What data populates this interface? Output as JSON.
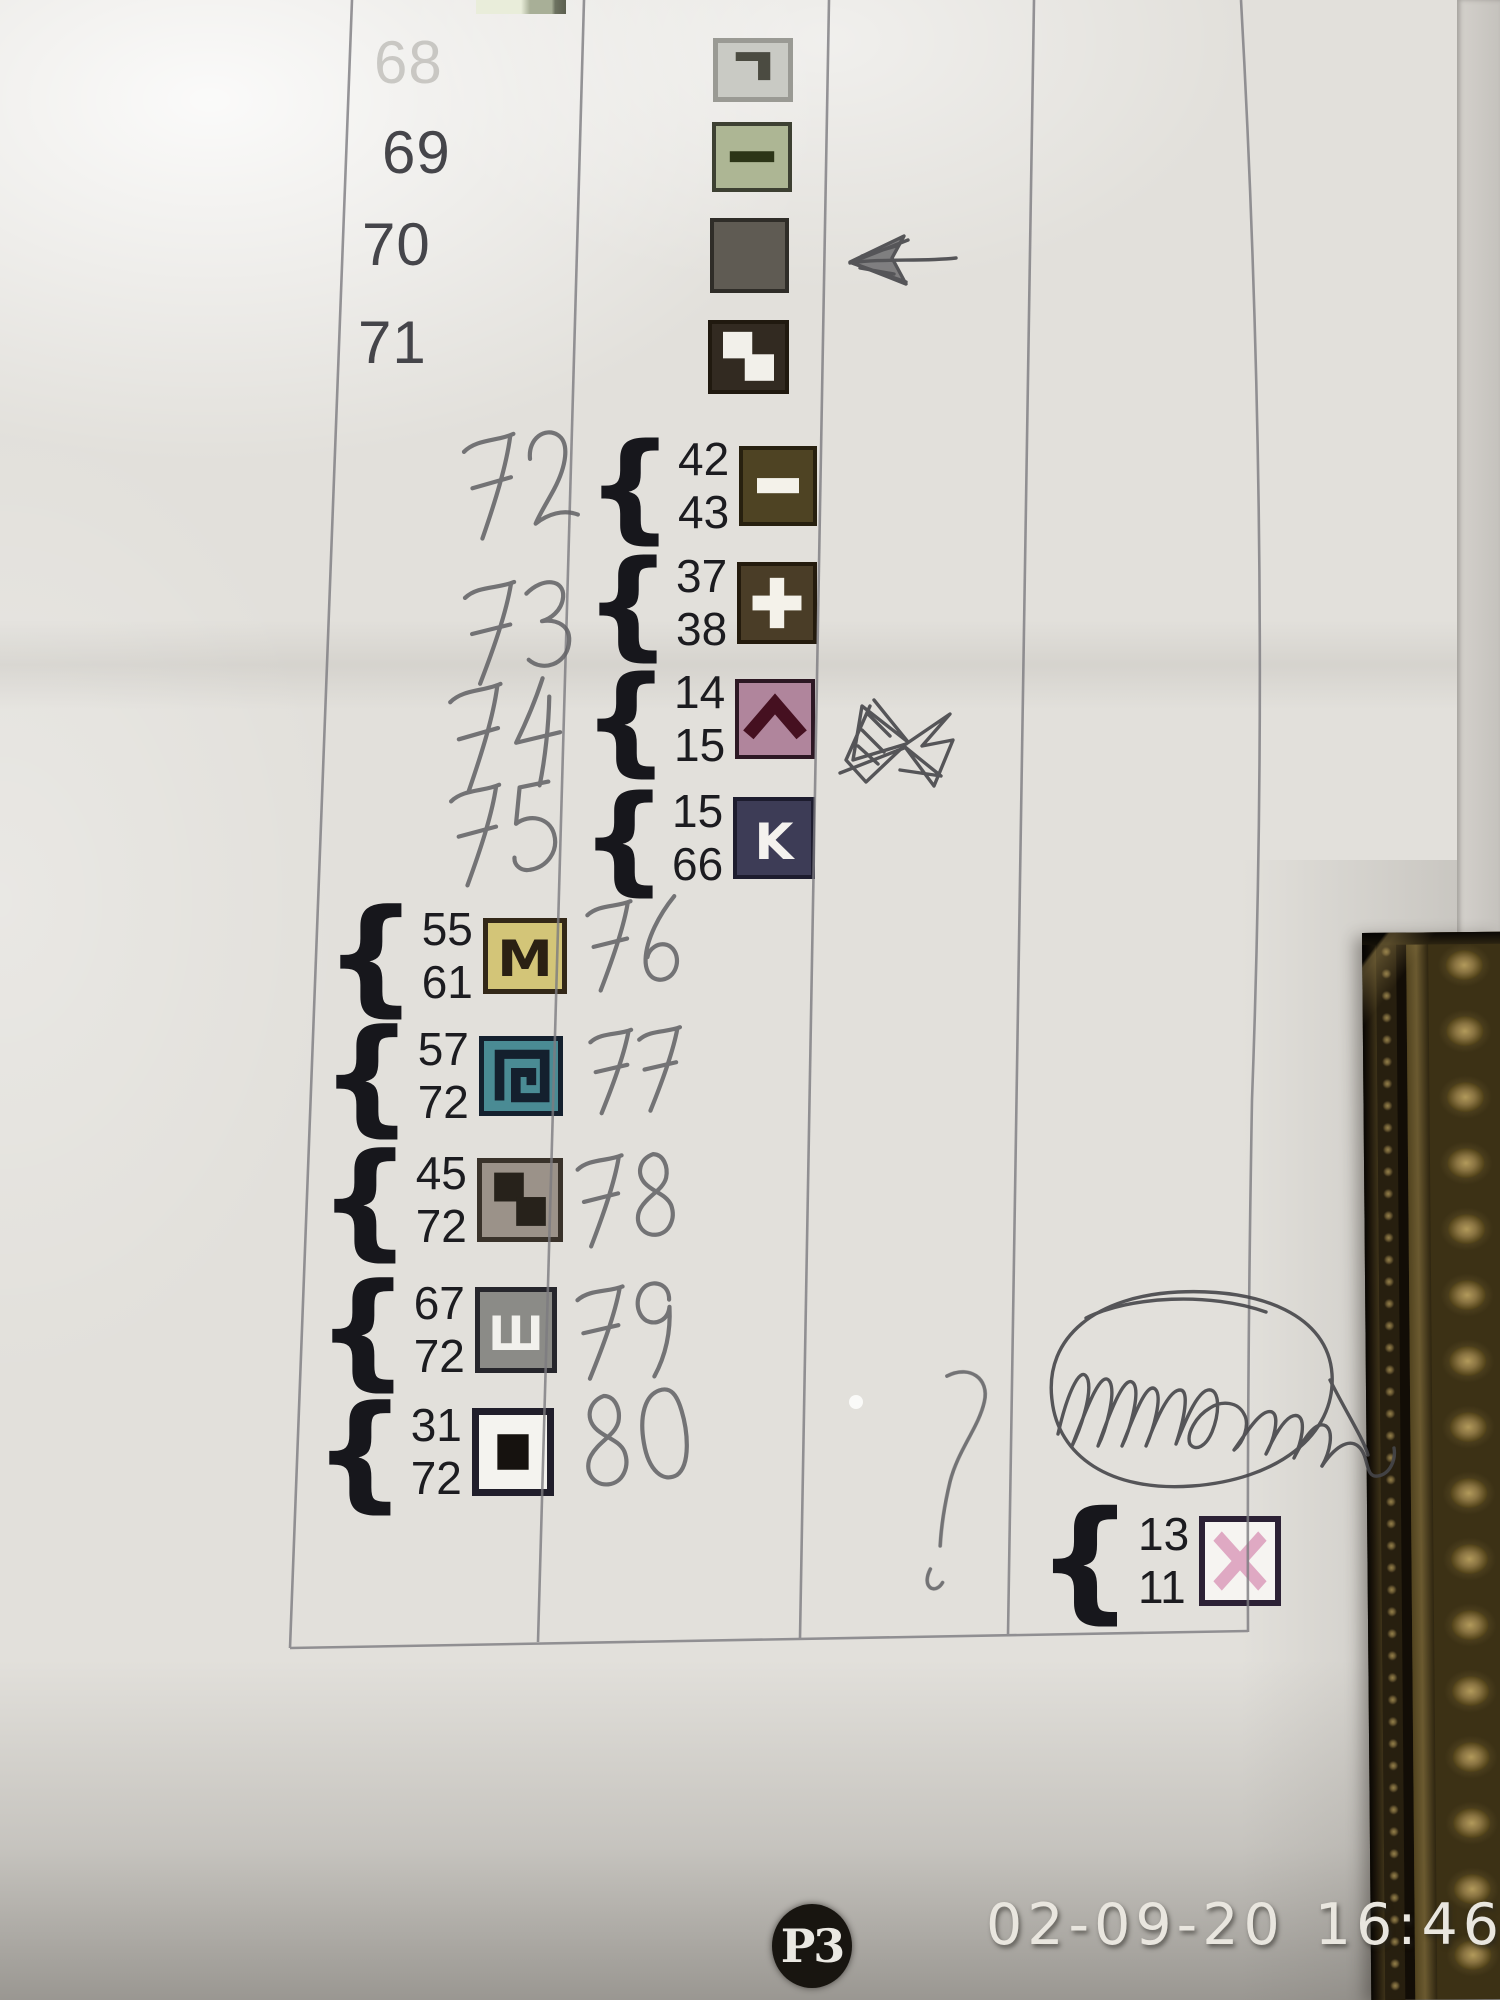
{
  "photo": {
    "stamp": {
      "date": "02-09-20",
      "time": "16:46"
    },
    "page_badge": "P3"
  },
  "legend": {
    "brace": "{",
    "single_rows": [
      {
        "num": "68",
        "symbol": "corner",
        "fill": "#c9cac4",
        "border": "#9a9a94",
        "glyph": "#4b4b41",
        "faded": true
      },
      {
        "num": "69",
        "symbol": "dash",
        "fill": "#adb694",
        "border": "#3d4032",
        "glyph": "#2c3517",
        "faded": false
      },
      {
        "num": "70",
        "symbol": "solid",
        "fill": "#5f5b53",
        "border": "#2f2d28",
        "glyph": "none",
        "faded": false
      },
      {
        "num": "71",
        "symbol": "steps",
        "fill": "#322a21",
        "border": "#20190f",
        "glyph": "#f2f0ea",
        "faded": false
      }
    ],
    "pair_rows_mid": [
      {
        "top": "42",
        "bottom": "43",
        "symbol": "minus",
        "fill": "#4e4323",
        "border": "#27200f",
        "glyph": "#f4f2ea"
      },
      {
        "top": "37",
        "bottom": "38",
        "symbol": "plus",
        "fill": "#4a3d27",
        "border": "#241b0d",
        "glyph": "#f4f2ea"
      },
      {
        "top": "14",
        "bottom": "15",
        "symbol": "chevron",
        "fill": "#b0859c",
        "border": "#2d1824",
        "glyph": "#451020"
      },
      {
        "top": "15",
        "bottom": "66",
        "symbol": "letter",
        "letter": "K",
        "fill": "#3d3c56",
        "border": "#1d1c2e",
        "glyph": "#f4f2ee"
      }
    ],
    "pair_rows_left": [
      {
        "top": "55",
        "bottom": "61",
        "symbol": "letter",
        "letter": "M",
        "fill": "#d3c578",
        "border": "#332818",
        "glyph": "#2a2013"
      },
      {
        "top": "57",
        "bottom": "72",
        "symbol": "spiral",
        "fill": "#4a8b94",
        "border": "#14202e",
        "glyph": "#14202e"
      },
      {
        "top": "45",
        "bottom": "72",
        "symbol": "steps",
        "fill": "#9b9289",
        "border": "#39322a",
        "glyph": "#27221b"
      },
      {
        "top": "67",
        "bottom": "72",
        "symbol": "letter",
        "letter": "Ш",
        "fill": "#8b8b87",
        "border": "#26262c",
        "glyph": "#f2f1ed"
      },
      {
        "top": "31",
        "bottom": "72",
        "symbol": "square",
        "fill": "#f4f3ef",
        "border": "#201e2b",
        "glyph": "#16120f"
      }
    ],
    "pair_row_right": {
      "top": "13",
      "bottom": "11",
      "symbol": "cross-x",
      "fill": "#f6f4f1",
      "border": "#2c2135",
      "glyph": "#dfa9c3"
    }
  },
  "handwriting": {
    "numbers": [
      "72",
      "73",
      "74",
      "75",
      "76",
      "77",
      "78",
      "79",
      "80"
    ],
    "question_mark": "?"
  },
  "annotations": {
    "marks": [
      "left-arrow",
      "bowtie-scribble",
      "question-stroke",
      "circled-signature"
    ]
  }
}
